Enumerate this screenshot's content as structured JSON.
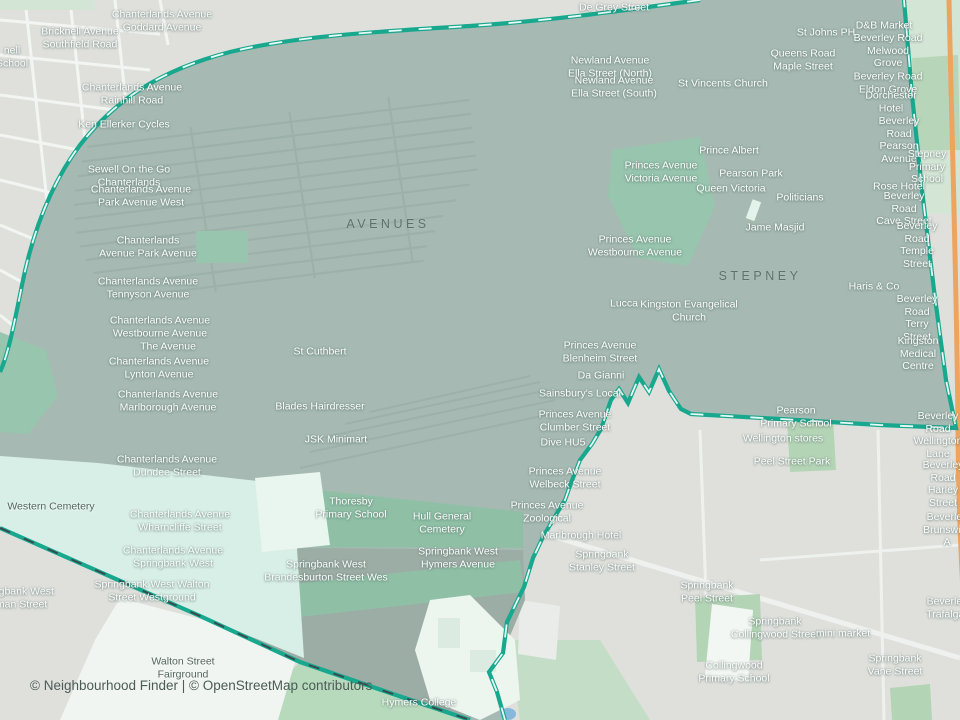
{
  "map": {
    "attribution": "© Neighbourhood Finder | © OpenStreetMap contributors",
    "colors": {
      "boundary_teal": "#17a88e",
      "boundary_dash_light": "#eafaf5",
      "boundary_dash_dark": "#39464d",
      "highlight_fill": "#a6bab3",
      "outside_gray": "#dfe0dc",
      "outside_green": "#d3e5d4",
      "park_green": "#97c5ae",
      "cemetery_mint": "#d8efe7",
      "main_road_orange": "#eda45f"
    },
    "region_labels": [
      {
        "text": "AVENUES",
        "x": 388,
        "y": 224
      },
      {
        "text": "STEPNEY",
        "x": 760,
        "y": 276
      }
    ],
    "place_labels": [
      {
        "text": "De Grey Street",
        "x": 614,
        "y": 8
      },
      {
        "text": "Chanterlands Avenue\nGoddard Avenue",
        "x": 162,
        "y": 21
      },
      {
        "text": "Bricknell Avenue\nSouthfield Road",
        "x": 80,
        "y": 38
      },
      {
        "text": "nell\nSchool",
        "x": 12,
        "y": 57
      },
      {
        "text": "D&B Market",
        "x": 884,
        "y": 26
      },
      {
        "text": "St Johns PH",
        "x": 826,
        "y": 33
      },
      {
        "text": "Beverley Road\nMelwood Grove",
        "x": 888,
        "y": 51
      },
      {
        "text": "Queens Road\nMaple Street",
        "x": 803,
        "y": 60
      },
      {
        "text": "Newland Avenue\nElla Street (North)",
        "x": 610,
        "y": 67
      },
      {
        "text": "Newland Avenue\nElla Street (South)",
        "x": 614,
        "y": 87
      },
      {
        "text": "St Vincents Church",
        "x": 723,
        "y": 84
      },
      {
        "text": "Beverley Road\nEldon Grove",
        "x": 888,
        "y": 83
      },
      {
        "text": "Dorchester Hotel",
        "x": 891,
        "y": 102
      },
      {
        "text": "Chanterlands Avenue\nRainhill Road",
        "x": 132,
        "y": 94
      },
      {
        "text": "Ken Ellerker Cycles",
        "x": 124,
        "y": 125
      },
      {
        "text": "Beverley Road\nPearson Avenue",
        "x": 899,
        "y": 140
      },
      {
        "text": "Stepney\nPrimary School",
        "x": 927,
        "y": 167
      },
      {
        "text": "Sewell On the Go\nChanterlands",
        "x": 129,
        "y": 176
      },
      {
        "text": "Prince Albert",
        "x": 729,
        "y": 151
      },
      {
        "text": "Princes Avenue\nVictoria Avenue",
        "x": 661,
        "y": 172
      },
      {
        "text": "Pearson Park",
        "x": 751,
        "y": 174
      },
      {
        "text": "Queen Victoria",
        "x": 731,
        "y": 189
      },
      {
        "text": "Chanterlands Avenue\nPark Avenue West",
        "x": 141,
        "y": 196
      },
      {
        "text": "Politicians",
        "x": 800,
        "y": 198
      },
      {
        "text": "Rose Hotel",
        "x": 899,
        "y": 187
      },
      {
        "text": "Beverley Road\nCave Street",
        "x": 904,
        "y": 209
      },
      {
        "text": "Jame Masjid",
        "x": 775,
        "y": 228
      },
      {
        "text": "Princes Avenue\nWestbourne Avenue",
        "x": 635,
        "y": 246
      },
      {
        "text": "Chanterlands\nAvenue Park Avenue",
        "x": 148,
        "y": 247
      },
      {
        "text": "Beverley Road\nTemple Street",
        "x": 917,
        "y": 245
      },
      {
        "text": "Chanterlands Avenue\nTennyson Avenue",
        "x": 148,
        "y": 288
      },
      {
        "text": "Haris & Co",
        "x": 874,
        "y": 287
      },
      {
        "text": "Lucca",
        "x": 624,
        "y": 304
      },
      {
        "text": "Kingston Evangelical\nChurch",
        "x": 689,
        "y": 311
      },
      {
        "text": "Chanterlands Avenue\nWestbourne Avenue",
        "x": 160,
        "y": 327
      },
      {
        "text": "Beverley Road\nTerry Street",
        "x": 917,
        "y": 318
      },
      {
        "text": "The Avenue",
        "x": 168,
        "y": 347
      },
      {
        "text": "St Cuthbert",
        "x": 320,
        "y": 352
      },
      {
        "text": "Princes Avenue\nBlenheim Street",
        "x": 600,
        "y": 352
      },
      {
        "text": "Chanterlands Avenue\nLynton Avenue",
        "x": 159,
        "y": 368
      },
      {
        "text": "Kingston\nMedical Centre",
        "x": 918,
        "y": 354
      },
      {
        "text": "Da Gianni",
        "x": 601,
        "y": 376
      },
      {
        "text": "Sainsbury's Local",
        "x": 580,
        "y": 394
      },
      {
        "text": "Chanterlands Avenue\nMarlborough Avenue",
        "x": 168,
        "y": 401
      },
      {
        "text": "Blades Hairdresser",
        "x": 320,
        "y": 407
      },
      {
        "text": "Pearson\nPrimary School",
        "x": 796,
        "y": 417
      },
      {
        "text": "Princes Avenue\nClumber Street",
        "x": 575,
        "y": 421
      },
      {
        "text": "JSK Minimart",
        "x": 336,
        "y": 440
      },
      {
        "text": "Wellington stores",
        "x": 783,
        "y": 439
      },
      {
        "text": "Dive HU5",
        "x": 563,
        "y": 443
      },
      {
        "text": "Beverley Road\nWellington Lane",
        "x": 938,
        "y": 435
      },
      {
        "text": "Peel Street Park",
        "x": 792,
        "y": 462
      },
      {
        "text": "Chanterlands Avenue\nDundee Street",
        "x": 167,
        "y": 466
      },
      {
        "text": "Princes Avenue\nWelbeck Street",
        "x": 565,
        "y": 478
      },
      {
        "text": "Beverley Road\nHarley Street",
        "x": 943,
        "y": 484
      },
      {
        "text": "Western Cemetery",
        "x": 51,
        "y": 507,
        "tone": "dark"
      },
      {
        "text": "Thoresby\nPrimary School",
        "x": 351,
        "y": 508
      },
      {
        "text": "Princes Avenue\nZoological",
        "x": 547,
        "y": 512
      },
      {
        "text": "Chanterlands Avenue\nWharncliffe Street",
        "x": 180,
        "y": 521
      },
      {
        "text": "Hull General\nCemetery",
        "x": 442,
        "y": 523
      },
      {
        "text": "Marlbrough Hotel",
        "x": 581,
        "y": 536
      },
      {
        "text": "Beverley\nBrunswick A",
        "x": 947,
        "y": 530
      },
      {
        "text": "Chanterlands Avenue\nSpringbank West",
        "x": 173,
        "y": 557
      },
      {
        "text": "Springbank West\nHymers Avenue",
        "x": 458,
        "y": 558
      },
      {
        "text": "Springbank\nStanley Street",
        "x": 602,
        "y": 561
      },
      {
        "text": "Springbank West\nBrandesburton Street Wes",
        "x": 326,
        "y": 571
      },
      {
        "text": "Springbank West Walton\nStreet Westground",
        "x": 152,
        "y": 591
      },
      {
        "text": "Springbank West\nPulman Street",
        "x": 14,
        "y": 598
      },
      {
        "text": "Springbank\nPeel Street",
        "x": 707,
        "y": 592
      },
      {
        "text": "Beverley\nTrafalgar",
        "x": 947,
        "y": 608
      },
      {
        "text": "Springbank\nCollingwood Street",
        "x": 775,
        "y": 628
      },
      {
        "text": "mini market",
        "x": 843,
        "y": 634
      },
      {
        "text": "Springbank\nVane Street",
        "x": 895,
        "y": 665
      },
      {
        "text": "Collingwood\nPrimary School",
        "x": 734,
        "y": 672
      },
      {
        "text": "Walton Street\nFairground",
        "x": 183,
        "y": 668,
        "tone": "dark"
      },
      {
        "text": "Hymers College",
        "x": 419,
        "y": 703
      }
    ]
  }
}
